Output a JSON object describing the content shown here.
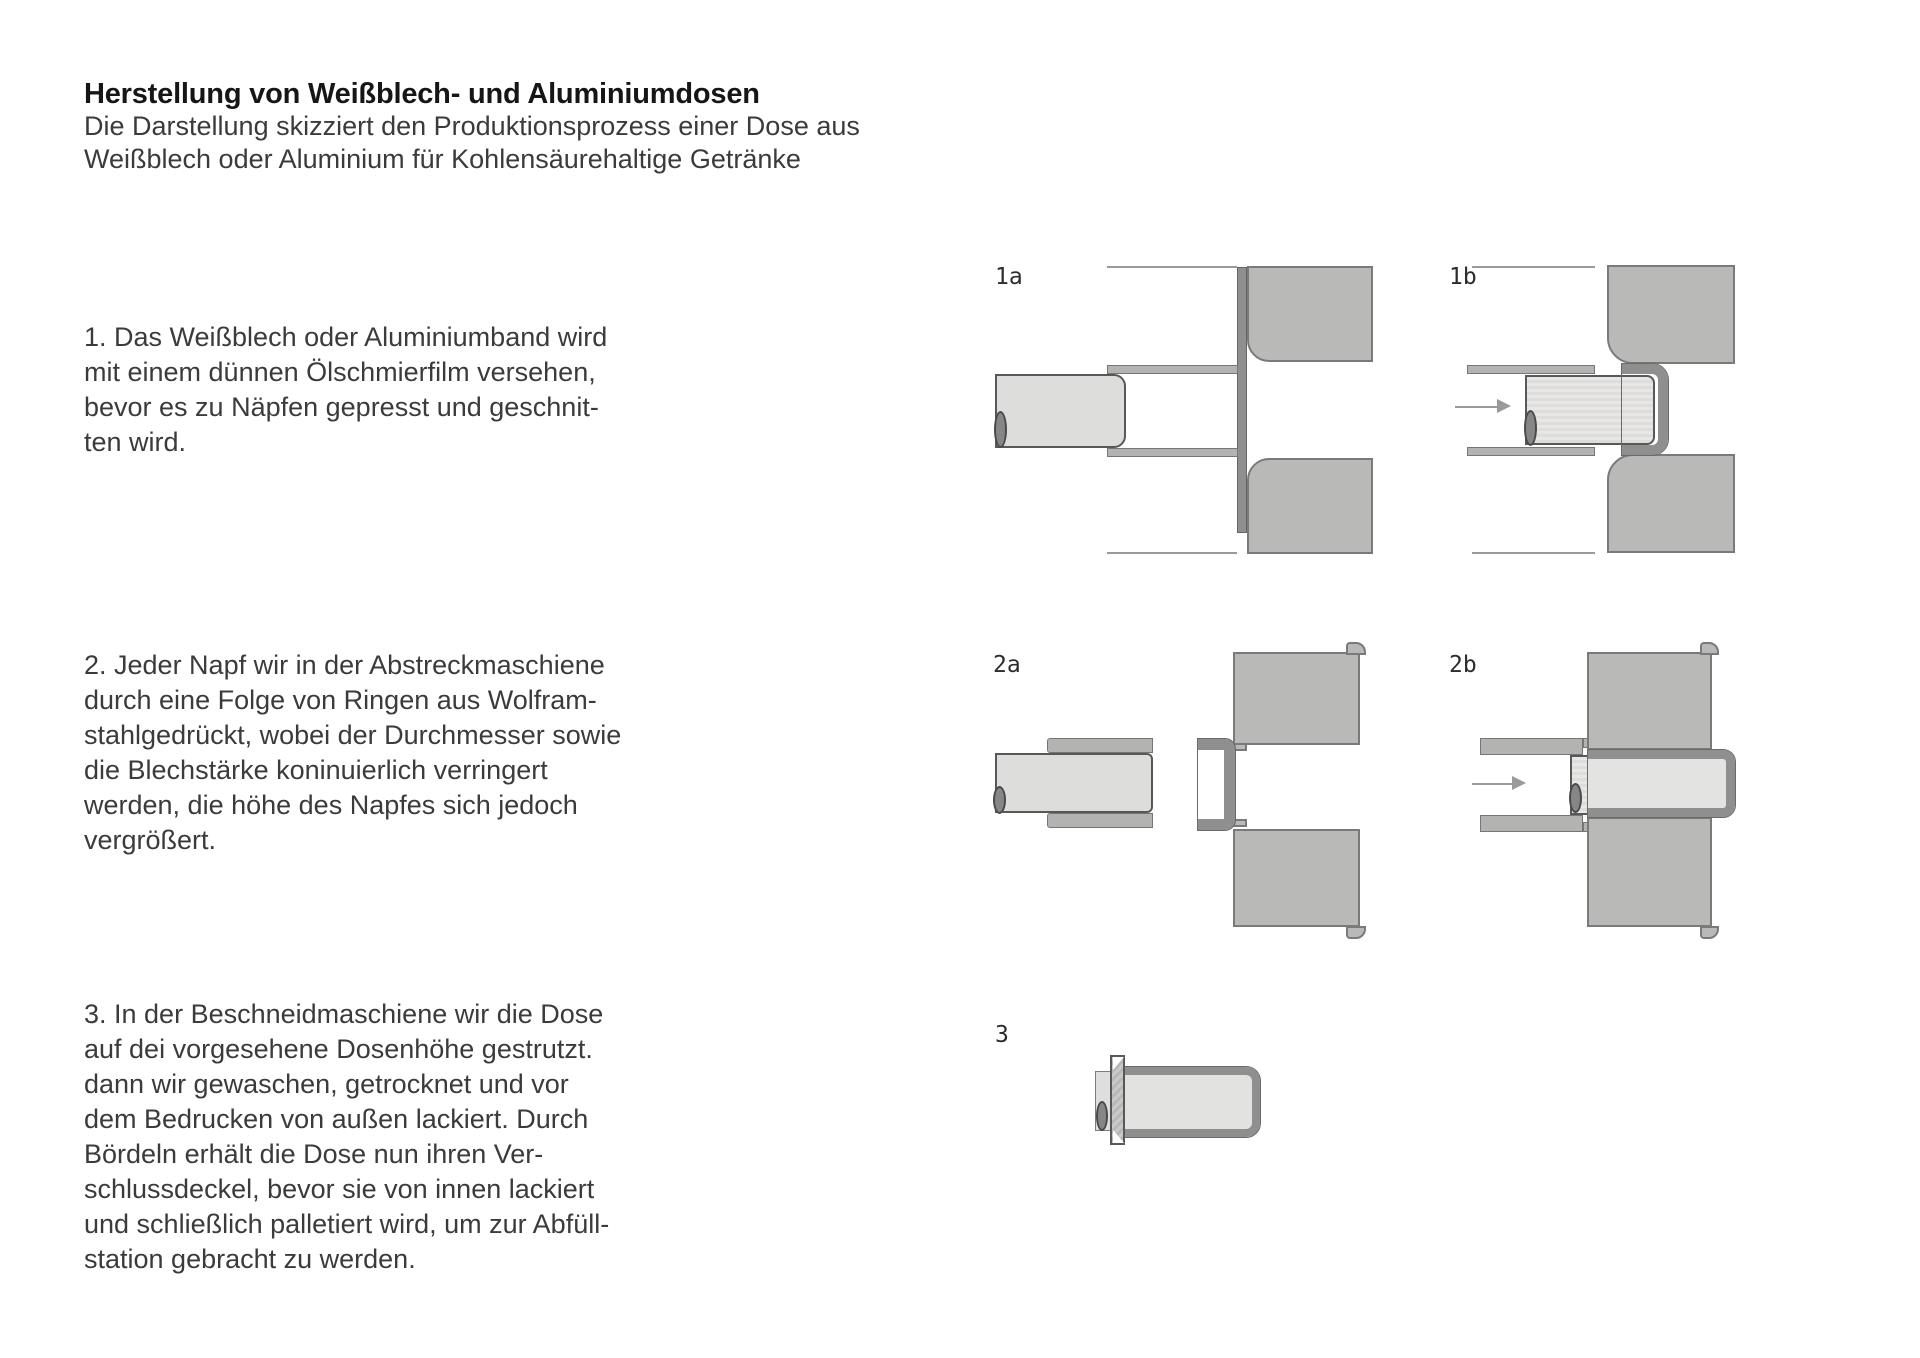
{
  "doc": {
    "title": "Herstellung von Weißblech- und Aluminiumdosen",
    "subtitle": "Die Darstellung skizziert den Produktionsprozess einer Dose aus\nWeißblech oder Aluminium für Kohlensäurehaltige Getränke",
    "steps": [
      {
        "text": "1. Das Weißblech oder Aluminiumband wird\nmit einem dünnen Ölschmierfilm versehen,\nbevor es zu Näpfen gepresst und geschnit-\nten wird."
      },
      {
        "text": "2. Jeder Napf wir in der Abstreckmaschiene\ndurch eine Folge  von Ringen aus Wolfram-\nstahlgedrückt, wobei der Durchmesser sowie\ndie Blechstärke koninuierlich verringert\nwerden, die höhe des Napfes sich jedoch\nvergrößert."
      },
      {
        "text": "3. In der Beschneidmaschiene wir die Dose\nauf dei vorgesehene Dosenhöhe gestrutzt.\ndann wir gewaschen, getrocknet und vor\ndem Bedrucken von außen lackiert. Durch\nBördeln erhält die Dose nun ihren Ver-\nschlussdeckel, bevor sie von innen lackiert\nund schließlich palletiert wird, um zur Abfüll-\nstation gebracht zu werden."
      }
    ]
  },
  "figures": {
    "f1a": {
      "label": "1a"
    },
    "f1b": {
      "label": "1b"
    },
    "f2a": {
      "label": "2a"
    },
    "f2b": {
      "label": "2b"
    },
    "f3": {
      "label": "3"
    }
  },
  "colors": {
    "background": "#ffffff",
    "text": "#3b3b3b",
    "die_gray": "#b9b9b8",
    "sheet_gray": "#8f8f8f",
    "punch_gray": "#dddddc",
    "plate_gray": "#b3b3b2",
    "line_gray": "#9a9a9a"
  }
}
